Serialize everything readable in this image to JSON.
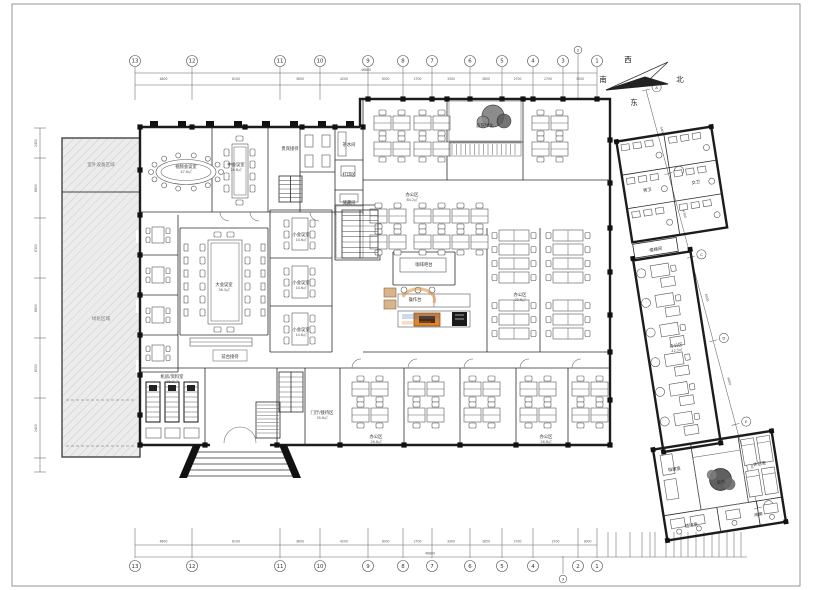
{
  "drawing": {
    "type": "building-floor-plan",
    "bg": "#ffffff"
  },
  "compass": {
    "west": "西",
    "south": "南",
    "north": "北",
    "east": "东"
  },
  "axes": {
    "top_cols": [
      {
        "label": "13",
        "x": 135
      },
      {
        "label": "12",
        "x": 192
      },
      {
        "label": "11",
        "x": 280
      },
      {
        "label": "10",
        "x": 320
      },
      {
        "label": "9",
        "x": 368
      },
      {
        "label": "8",
        "x": 403
      },
      {
        "label": "7",
        "x": 432
      },
      {
        "label": "6",
        "x": 470
      },
      {
        "label": "5",
        "x": 502
      },
      {
        "label": "4",
        "x": 533
      },
      {
        "label": "3",
        "x": 563
      },
      {
        "label": "2",
        "x": 578,
        "minor": true
      },
      {
        "label": "1",
        "x": 597
      }
    ],
    "top_dims": [
      "4800",
      "8100",
      "3600",
      "4200",
      "3000",
      "2700",
      "3300",
      "2850",
      "2700",
      "2700",
      "3000"
    ],
    "top_total": "46800",
    "bottom_cols": [
      {
        "label": "13",
        "x": 135
      },
      {
        "label": "12",
        "x": 192
      },
      {
        "label": "11",
        "x": 280
      },
      {
        "label": "10",
        "x": 320
      },
      {
        "label": "9",
        "x": 368
      },
      {
        "label": "8",
        "x": 403
      },
      {
        "label": "7",
        "x": 432
      },
      {
        "label": "6",
        "x": 470
      },
      {
        "label": "5",
        "x": 502
      },
      {
        "label": "4",
        "x": 533
      },
      {
        "label": "2",
        "x": 578
      },
      {
        "label": "1",
        "x": 597
      }
    ],
    "bottom_minor": {
      "label": "3",
      "x": 563
    },
    "bottom_dims": [
      "4800",
      "8100",
      "3600",
      "4200",
      "3000",
      "2700",
      "3300",
      "2850",
      "2700",
      "2700",
      "3000"
    ],
    "bottom_total": "46800",
    "left_dims": [
      "2400",
      "6600",
      "6300",
      "6600",
      "6000",
      "2400"
    ],
    "right_labels": [
      "A",
      "B",
      "C",
      "D",
      "E",
      "F"
    ],
    "right_dims": [
      "5400",
      "6300",
      "6000",
      "6600",
      "5700"
    ]
  },
  "rooms": [
    {
      "text": "视频会议室",
      "sub": "47.6㎡",
      "x": 186,
      "y": 168
    },
    {
      "text": "中会议室",
      "sub": "26.8㎡",
      "x": 236,
      "y": 166
    },
    {
      "text": "贵宾接待",
      "x": 290,
      "y": 150
    },
    {
      "text": "茶水间",
      "x": 349,
      "y": 146
    },
    {
      "text": "打印区",
      "x": 349,
      "y": 176
    },
    {
      "text": "储藏间",
      "x": 349,
      "y": 204
    },
    {
      "text": "庭院绿化",
      "x": 485,
      "y": 127
    },
    {
      "text": "大会议室",
      "sub": "56.3㎡",
      "x": 224,
      "y": 286
    },
    {
      "text": "小会议室",
      "sub": "14.6㎡",
      "x": 301,
      "y": 236
    },
    {
      "text": "小会议室",
      "sub": "14.6㎡",
      "x": 301,
      "y": 284
    },
    {
      "text": "小会议室",
      "sub": "14.6㎡",
      "x": 301,
      "y": 331
    },
    {
      "text": "前台接待",
      "x": 230,
      "y": 358
    },
    {
      "text": "咖啡吧台",
      "x": 424,
      "y": 266
    },
    {
      "text": "操作台",
      "x": 415,
      "y": 301
    },
    {
      "text": "机房/资料室",
      "sub": "21.3㎡",
      "x": 172,
      "y": 378
    },
    {
      "text": "门厅/接待区",
      "sub": "35.6㎡",
      "x": 322,
      "y": 414
    },
    {
      "text": "办公区",
      "sub": "84.2㎡",
      "x": 412,
      "y": 196
    },
    {
      "text": "办公区",
      "sub": "32.6㎡",
      "x": 520,
      "y": 296
    },
    {
      "text": "办公区",
      "sub": "26.8㎡",
      "x": 376,
      "y": 438
    },
    {
      "text": "办公区",
      "sub": "26.8㎡",
      "x": 546,
      "y": 438
    },
    {
      "text": "室外设备区域",
      "x": 101,
      "y": 166,
      "cls": "area"
    },
    {
      "text": "绿化区域",
      "x": 101,
      "y": 320,
      "cls": "area"
    },
    {
      "text": "男卫",
      "x": 641,
      "y": 192,
      "wing": true
    },
    {
      "text": "女卫",
      "x": 690,
      "y": 192,
      "wing": true
    },
    {
      "text": "楼梯间",
      "x": 640,
      "y": 252,
      "wing": true
    },
    {
      "text": "办公区",
      "sub": "42.3㎡",
      "x": 645,
      "y": 350,
      "wing": true
    },
    {
      "text": "档案室",
      "x": 624,
      "y": 472,
      "wing": true
    },
    {
      "text": "庭院",
      "x": 668,
      "y": 492,
      "wing": true
    },
    {
      "text": "休息室",
      "x": 709,
      "y": 480,
      "wing": true
    },
    {
      "text": "值班室",
      "x": 632,
      "y": 530,
      "wing": true
    },
    {
      "text": "库房",
      "x": 700,
      "y": 530,
      "wing": true
    }
  ],
  "watermark": {
    "orange": "#dd8530",
    "blue": "#4a72b8"
  }
}
